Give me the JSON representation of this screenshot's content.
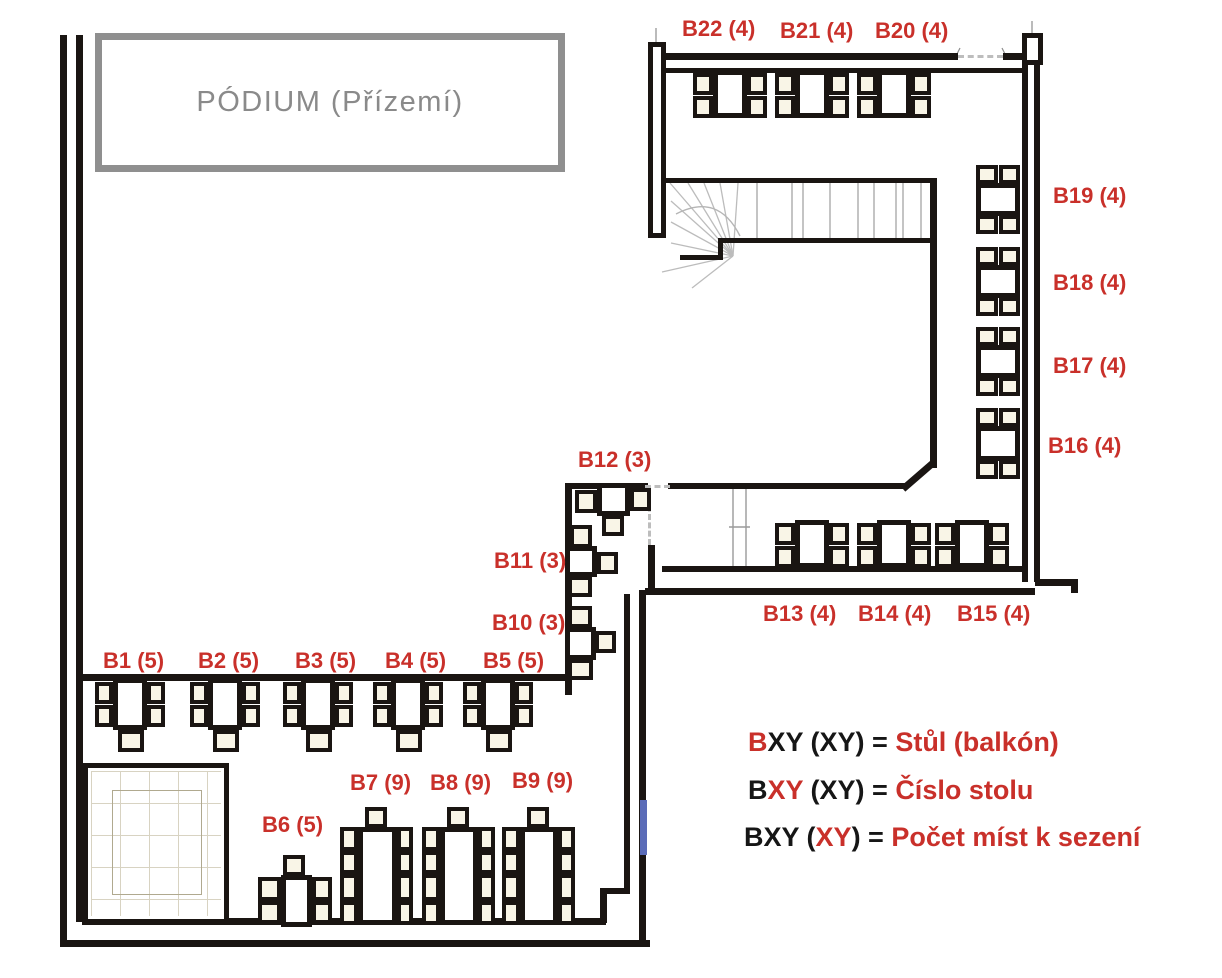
{
  "podium": {
    "label": "PÓDIUM (Přízemí)"
  },
  "legend": {
    "rows": [
      {
        "parts": [
          {
            "t": "B",
            "c": "r"
          },
          {
            "t": "XY (XY) = ",
            "c": "k"
          },
          {
            "t": "Stůl (balkón)",
            "c": "r"
          }
        ]
      },
      {
        "parts": [
          {
            "t": "B",
            "c": "k"
          },
          {
            "t": "XY",
            "c": "r"
          },
          {
            "t": " (XY) = ",
            "c": "k"
          },
          {
            "t": "Číslo stolu",
            "c": "r"
          }
        ]
      },
      {
        "parts": [
          {
            "t": "BXY (",
            "c": "k"
          },
          {
            "t": "XY",
            "c": "r"
          },
          {
            "t": ") = ",
            "c": "k"
          },
          {
            "t": "Počet míst k sezení",
            "c": "r"
          }
        ]
      }
    ]
  },
  "colors": {
    "red": "#c9302a",
    "wall": "#1a1512",
    "gray": "#8a8a8a",
    "chair_fill": "#f9f5e7",
    "blue_mark": "#5b6cb8"
  },
  "tables": [
    {
      "id": "B1",
      "label": "B1 (5)",
      "seats": 5,
      "label_pos": [
        103,
        648
      ],
      "table": [
        113,
        678,
        34,
        52
      ],
      "chairs": [
        [
          95,
          682,
          18,
          22
        ],
        [
          95,
          705,
          18,
          22
        ],
        [
          147,
          682,
          18,
          22
        ],
        [
          147,
          705,
          18,
          22
        ],
        [
          118,
          730,
          26,
          22
        ]
      ]
    },
    {
      "id": "B2",
      "label": "B2 (5)",
      "seats": 5,
      "label_pos": [
        198,
        648
      ],
      "table": [
        208,
        678,
        34,
        52
      ],
      "chairs": [
        [
          190,
          682,
          18,
          22
        ],
        [
          190,
          705,
          18,
          22
        ],
        [
          242,
          682,
          18,
          22
        ],
        [
          242,
          705,
          18,
          22
        ],
        [
          213,
          730,
          26,
          22
        ]
      ]
    },
    {
      "id": "B3",
      "label": "B3 (5)",
      "seats": 5,
      "label_pos": [
        295,
        648
      ],
      "table": [
        301,
        678,
        34,
        52
      ],
      "chairs": [
        [
          283,
          682,
          18,
          22
        ],
        [
          283,
          705,
          18,
          22
        ],
        [
          335,
          682,
          18,
          22
        ],
        [
          335,
          705,
          18,
          22
        ],
        [
          306,
          730,
          26,
          22
        ]
      ]
    },
    {
      "id": "B4",
      "label": "B4 (5)",
      "seats": 5,
      "label_pos": [
        385,
        648
      ],
      "table": [
        391,
        678,
        34,
        52
      ],
      "chairs": [
        [
          373,
          682,
          18,
          22
        ],
        [
          373,
          705,
          18,
          22
        ],
        [
          425,
          682,
          18,
          22
        ],
        [
          425,
          705,
          18,
          22
        ],
        [
          396,
          730,
          26,
          22
        ]
      ]
    },
    {
      "id": "B5",
      "label": "B5 (5)",
      "seats": 5,
      "label_pos": [
        483,
        648
      ],
      "table": [
        481,
        678,
        34,
        52
      ],
      "chairs": [
        [
          463,
          682,
          18,
          22
        ],
        [
          463,
          705,
          18,
          22
        ],
        [
          515,
          682,
          18,
          22
        ],
        [
          515,
          705,
          18,
          22
        ],
        [
          486,
          730,
          26,
          22
        ]
      ]
    },
    {
      "id": "B6",
      "label": "B6 (5)",
      "seats": 5,
      "label_pos": [
        262,
        812
      ],
      "table": [
        281,
        875,
        31,
        52
      ],
      "chairs": [
        [
          283,
          855,
          22,
          21
        ],
        [
          258,
          877,
          23,
          24
        ],
        [
          258,
          901,
          23,
          23
        ],
        [
          312,
          877,
          20,
          24
        ],
        [
          312,
          901,
          20,
          23
        ]
      ]
    },
    {
      "id": "B7",
      "label": "B7 (9)",
      "seats": 9,
      "label_pos": [
        350,
        770
      ],
      "table": [
        358,
        827,
        39,
        98
      ],
      "chairs": [
        [
          365,
          807,
          22,
          21
        ],
        [
          340,
          827,
          18,
          24
        ],
        [
          340,
          851,
          18,
          23
        ],
        [
          340,
          874,
          18,
          27
        ],
        [
          340,
          901,
          18,
          24
        ],
        [
          397,
          827,
          16,
          24
        ],
        [
          397,
          851,
          16,
          23
        ],
        [
          397,
          874,
          16,
          27
        ],
        [
          397,
          901,
          16,
          24
        ]
      ]
    },
    {
      "id": "B8",
      "label": "B8 (9)",
      "seats": 9,
      "label_pos": [
        430,
        770
      ],
      "table": [
        440,
        827,
        38,
        98
      ],
      "chairs": [
        [
          447,
          807,
          22,
          21
        ],
        [
          422,
          827,
          18,
          24
        ],
        [
          422,
          851,
          18,
          23
        ],
        [
          422,
          874,
          18,
          27
        ],
        [
          422,
          901,
          18,
          24
        ],
        [
          478,
          827,
          17,
          24
        ],
        [
          478,
          851,
          17,
          23
        ],
        [
          478,
          874,
          17,
          27
        ],
        [
          478,
          901,
          17,
          24
        ]
      ]
    },
    {
      "id": "B9",
      "label": "B9 (9)",
      "seats": 9,
      "label_pos": [
        512,
        768
      ],
      "table": [
        520,
        827,
        38,
        98
      ],
      "chairs": [
        [
          527,
          807,
          22,
          21
        ],
        [
          502,
          827,
          18,
          24
        ],
        [
          502,
          851,
          18,
          23
        ],
        [
          502,
          874,
          18,
          27
        ],
        [
          502,
          901,
          18,
          24
        ],
        [
          558,
          827,
          17,
          24
        ],
        [
          558,
          851,
          17,
          23
        ],
        [
          558,
          874,
          17,
          27
        ],
        [
          558,
          901,
          17,
          24
        ]
      ]
    },
    {
      "id": "B10",
      "label": "B10 (3)",
      "seats": 3,
      "label_pos": [
        492,
        610
      ],
      "table": [
        565,
        627,
        31,
        33
      ],
      "chairs": [
        [
          568,
          606,
          24,
          22
        ],
        [
          595,
          631,
          21,
          22
        ],
        [
          568,
          659,
          25,
          21
        ]
      ]
    },
    {
      "id": "B11",
      "label": "B11 (3)",
      "seats": 3,
      "label_pos": [
        494,
        548
      ],
      "table": [
        565,
        546,
        32,
        31
      ],
      "chairs": [
        [
          570,
          525,
          22,
          23
        ],
        [
          597,
          552,
          21,
          22
        ],
        [
          568,
          576,
          24,
          21
        ]
      ]
    },
    {
      "id": "B12",
      "label": "B12 (3)",
      "seats": 3,
      "label_pos": [
        578,
        447
      ],
      "table": [
        597,
        483,
        33,
        33
      ],
      "chairs": [
        [
          575,
          490,
          22,
          23
        ],
        [
          630,
          488,
          21,
          23
        ],
        [
          602,
          515,
          22,
          21
        ]
      ]
    },
    {
      "id": "B13",
      "label": "B13 (4)",
      "seats": 4,
      "label_pos": [
        763,
        601
      ],
      "table": [
        795,
        520,
        34,
        48
      ],
      "chairs": [
        [
          775,
          523,
          20,
          22
        ],
        [
          775,
          546,
          20,
          22
        ],
        [
          829,
          523,
          20,
          22
        ],
        [
          829,
          546,
          20,
          22
        ]
      ]
    },
    {
      "id": "B14",
      "label": "B14 (4)",
      "seats": 4,
      "label_pos": [
        858,
        601
      ],
      "table": [
        877,
        520,
        34,
        48
      ],
      "chairs": [
        [
          857,
          523,
          20,
          22
        ],
        [
          857,
          546,
          20,
          22
        ],
        [
          911,
          523,
          20,
          22
        ],
        [
          911,
          546,
          20,
          22
        ]
      ]
    },
    {
      "id": "B15",
      "label": "B15 (4)",
      "seats": 4,
      "label_pos": [
        957,
        601
      ],
      "table": [
        955,
        520,
        34,
        48
      ],
      "chairs": [
        [
          935,
          523,
          20,
          22
        ],
        [
          935,
          546,
          20,
          22
        ],
        [
          989,
          523,
          20,
          22
        ],
        [
          989,
          546,
          20,
          22
        ]
      ]
    },
    {
      "id": "B16",
      "label": "B16 (4)",
      "seats": 4,
      "label_pos": [
        1048,
        433
      ],
      "table": [
        976,
        426,
        44,
        35
      ],
      "chairs": [
        [
          976,
          408,
          22,
          19
        ],
        [
          999,
          408,
          21,
          19
        ],
        [
          976,
          460,
          22,
          19
        ],
        [
          999,
          460,
          21,
          19
        ]
      ]
    },
    {
      "id": "B17",
      "label": "B17 (4)",
      "seats": 4,
      "label_pos": [
        1053,
        353
      ],
      "table": [
        976,
        345,
        44,
        33
      ],
      "chairs": [
        [
          976,
          327,
          22,
          19
        ],
        [
          999,
          327,
          21,
          19
        ],
        [
          976,
          377,
          22,
          19
        ],
        [
          999,
          377,
          21,
          19
        ]
      ]
    },
    {
      "id": "B18",
      "label": "B18 (4)",
      "seats": 4,
      "label_pos": [
        1053,
        270
      ],
      "table": [
        976,
        265,
        44,
        33
      ],
      "chairs": [
        [
          976,
          247,
          22,
          19
        ],
        [
          999,
          247,
          21,
          19
        ],
        [
          976,
          297,
          22,
          19
        ],
        [
          999,
          297,
          21,
          19
        ]
      ]
    },
    {
      "id": "B19",
      "label": "B19 (4)",
      "seats": 4,
      "label_pos": [
        1053,
        183
      ],
      "table": [
        976,
        183,
        44,
        33
      ],
      "chairs": [
        [
          976,
          165,
          22,
          19
        ],
        [
          999,
          165,
          21,
          19
        ],
        [
          976,
          215,
          22,
          19
        ],
        [
          999,
          215,
          21,
          19
        ]
      ]
    },
    {
      "id": "B20",
      "label": "B20 (4)",
      "seats": 4,
      "label_pos": [
        875,
        18
      ],
      "table": [
        877,
        70,
        34,
        48
      ],
      "chairs": [
        [
          857,
          73,
          20,
          22
        ],
        [
          857,
          96,
          20,
          22
        ],
        [
          911,
          73,
          20,
          22
        ],
        [
          911,
          96,
          20,
          22
        ]
      ]
    },
    {
      "id": "B21",
      "label": "B21 (4)",
      "seats": 4,
      "label_pos": [
        780,
        18
      ],
      "table": [
        795,
        70,
        34,
        48
      ],
      "chairs": [
        [
          775,
          73,
          20,
          22
        ],
        [
          775,
          96,
          20,
          22
        ],
        [
          829,
          73,
          20,
          22
        ],
        [
          829,
          96,
          20,
          22
        ]
      ]
    },
    {
      "id": "B22",
      "label": "B22 (4)",
      "seats": 4,
      "label_pos": [
        682,
        16
      ],
      "table": [
        713,
        70,
        34,
        48
      ],
      "chairs": [
        [
          693,
          73,
          20,
          22
        ],
        [
          693,
          96,
          20,
          22
        ],
        [
          747,
          73,
          20,
          22
        ],
        [
          747,
          96,
          20,
          22
        ]
      ]
    }
  ]
}
